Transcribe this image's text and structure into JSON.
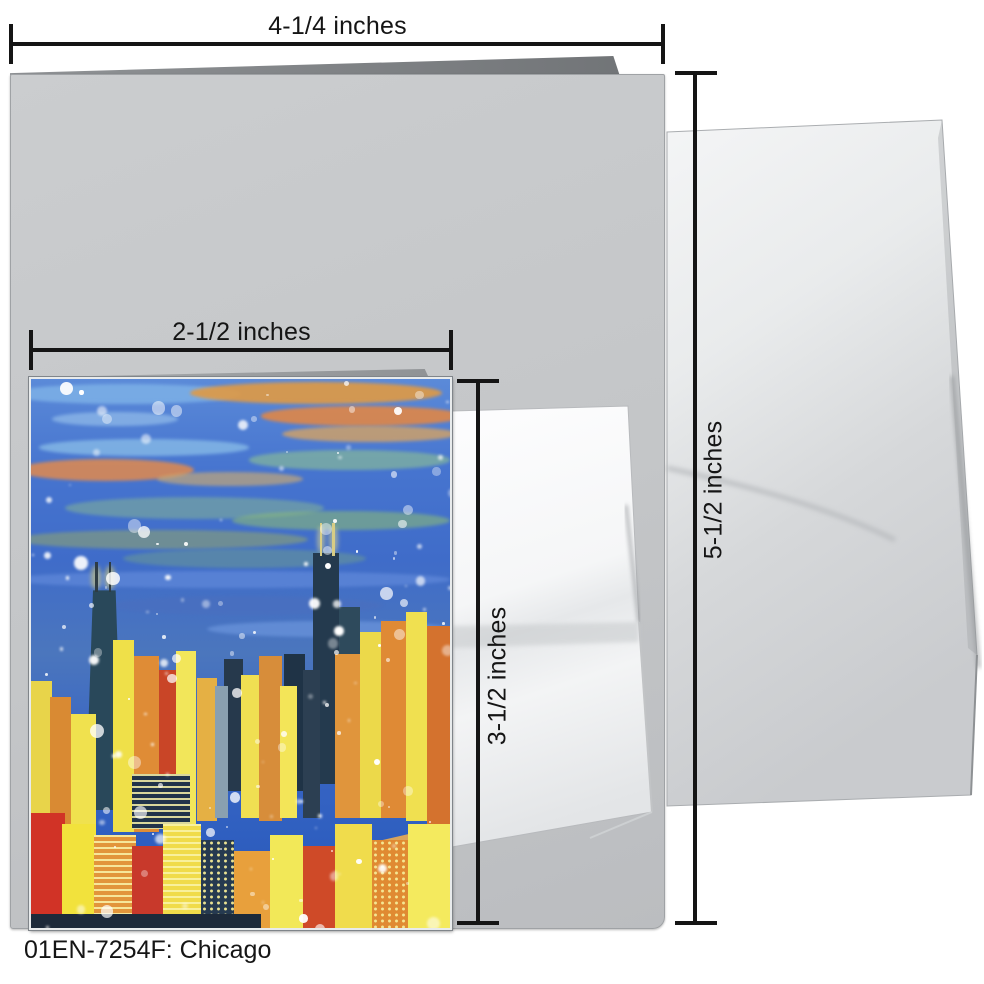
{
  "product": {
    "code_label": "01EN-7254F: Chicago"
  },
  "annotations": {
    "card_width": "4-1/4 inches",
    "card_height": "5-1/2 inches",
    "front_width": "2-1/2 inches",
    "front_height": "3-1/2 inches"
  },
  "colors": {
    "background": "#ffffff",
    "card_gray": "#c6c8ca",
    "fold_gray": "#7c7f83",
    "envelope_light": "#f4f5f6",
    "envelope_shade": "#c9cbce",
    "dimension_line": "#151515",
    "caption_text": "#151515"
  },
  "painting": {
    "sky": {
      "stops": [
        "#5b8ad8",
        "#4674cf",
        "#3f6cc9",
        "#4b76bd",
        "#3a66c4",
        "#2f5fc0",
        "#2a54b4"
      ]
    },
    "sky_streaks": [
      {
        "x": -5,
        "y": 1,
        "w": 55,
        "h": 3.5,
        "c": "#7fb3e8",
        "o": 0.8
      },
      {
        "x": 38,
        "y": 0.5,
        "w": 60,
        "h": 4,
        "c": "#e09a44",
        "o": 0.9
      },
      {
        "x": 55,
        "y": 5,
        "w": 48,
        "h": 3.5,
        "c": "#e8873f",
        "o": 0.85
      },
      {
        "x": 60,
        "y": 8.5,
        "w": 42,
        "h": 3,
        "c": "#e8a854",
        "o": 0.7
      },
      {
        "x": 5,
        "y": 6,
        "w": 30,
        "h": 2.5,
        "c": "#9fc8ee",
        "o": 0.6
      },
      {
        "x": 2,
        "y": 11,
        "w": 50,
        "h": 3,
        "c": "#8fc3ea",
        "o": 0.7
      },
      {
        "x": -3,
        "y": 14.5,
        "w": 42,
        "h": 4,
        "c": "#e28a4d",
        "o": 0.85
      },
      {
        "x": 52,
        "y": 13,
        "w": 48,
        "h": 3.5,
        "c": "#86b89a",
        "o": 0.7
      },
      {
        "x": 30,
        "y": 17,
        "w": 35,
        "h": 2.5,
        "c": "#d8b06a",
        "o": 0.6
      },
      {
        "x": 8,
        "y": 21.5,
        "w": 62,
        "h": 4,
        "c": "#7fae9a",
        "o": 0.6
      },
      {
        "x": 48,
        "y": 24,
        "w": 52,
        "h": 3.5,
        "c": "#8fbf72",
        "o": 0.55
      },
      {
        "x": -4,
        "y": 27.5,
        "w": 70,
        "h": 3.5,
        "c": "#94a86b",
        "o": 0.55
      },
      {
        "x": 22,
        "y": 31,
        "w": 58,
        "h": 3.5,
        "c": "#6f9e8e",
        "o": 0.5
      },
      {
        "x": -5,
        "y": 35,
        "w": 105,
        "h": 3,
        "c": "#5d86d8",
        "o": 0.8
      },
      {
        "x": 18,
        "y": 39.5,
        "w": 66,
        "h": 3.5,
        "c": "#4a6fbf",
        "o": 0.7
      },
      {
        "x": 42,
        "y": 44,
        "w": 58,
        "h": 3,
        "c": "#6c96dd",
        "o": 0.7
      }
    ],
    "glows": [
      {
        "x": 14.4,
        "y": 34,
        "w": 2.4,
        "h": 4.2,
        "c": "#e8d45f",
        "o": 0.5
      },
      {
        "x": 17.7,
        "y": 34,
        "w": 2.4,
        "h": 4.2,
        "c": "#e8d45f",
        "o": 0.5
      },
      {
        "x": 68.2,
        "y": 27,
        "w": 2,
        "h": 4.5,
        "c": "#f0e387",
        "o": 0.5
      },
      {
        "x": 71.2,
        "y": 27,
        "w": 2,
        "h": 4.5,
        "c": "#f0e387",
        "o": 0.5
      }
    ],
    "antennas": [
      {
        "x": 15.3,
        "y": 33.4,
        "w": 0.7,
        "h": 5.4,
        "c": "#2e3c44"
      },
      {
        "x": 18.5,
        "y": 33.4,
        "w": 0.7,
        "h": 5.4,
        "c": "#2e3c44"
      },
      {
        "x": 68.9,
        "y": 26.2,
        "w": 0.6,
        "h": 6,
        "c": "#d8cd85"
      },
      {
        "x": 71.9,
        "y": 26.2,
        "w": 0.6,
        "h": 6,
        "c": "#d8cd85"
      }
    ],
    "buildings": [
      {
        "x": 13,
        "y": 38.5,
        "w": 9,
        "h": 40,
        "c": "#29485a",
        "taper": true
      },
      {
        "x": 67.3,
        "y": 31.7,
        "w": 6.3,
        "h": 42,
        "c": "#243a4e"
      },
      {
        "x": 73.4,
        "y": 41.5,
        "w": 5.2,
        "h": 32,
        "c": "#2e4a5c"
      },
      {
        "x": 60.5,
        "y": 50,
        "w": 5,
        "h": 25,
        "c": "#1f3346"
      },
      {
        "x": 46,
        "y": 51,
        "w": 4.5,
        "h": 24,
        "c": "#26394c"
      },
      {
        "x": 0,
        "y": 55,
        "w": 5,
        "h": 30,
        "c": "#e8d44a"
      },
      {
        "x": 4.5,
        "y": 58,
        "w": 5,
        "h": 28,
        "c": "#d98a33"
      },
      {
        "x": 9.5,
        "y": 61,
        "w": 6,
        "h": 25,
        "c": "#f0e14e"
      },
      {
        "x": 19.5,
        "y": 47.5,
        "w": 5,
        "h": 35,
        "c": "#efe049"
      },
      {
        "x": 24.5,
        "y": 50.5,
        "w": 6,
        "h": 32,
        "c": "#df8c36"
      },
      {
        "x": 30.5,
        "y": 53,
        "w": 4,
        "h": 28,
        "c": "#c94527"
      },
      {
        "x": 34.5,
        "y": 49.5,
        "w": 5,
        "h": 32,
        "c": "#f2e65a"
      },
      {
        "x": 39.5,
        "y": 54.5,
        "w": 5,
        "h": 26,
        "c": "#e5b044"
      },
      {
        "x": 44,
        "y": 56,
        "w": 3,
        "h": 24,
        "c": "#8aa0b0"
      },
      {
        "x": 50,
        "y": 54,
        "w": 5,
        "h": 26,
        "c": "#f0df52"
      },
      {
        "x": 54.5,
        "y": 50.5,
        "w": 5.5,
        "h": 30,
        "c": "#d78d3a"
      },
      {
        "x": 59.5,
        "y": 56,
        "w": 4,
        "h": 24,
        "c": "#f3e558"
      },
      {
        "x": 65,
        "y": 53,
        "w": 4,
        "h": 27,
        "c": "#2c3f52"
      },
      {
        "x": 72.5,
        "y": 50,
        "w": 6,
        "h": 30,
        "c": "#e0953c"
      },
      {
        "x": 78.5,
        "y": 46,
        "w": 5,
        "h": 34,
        "c": "#ecd94a"
      },
      {
        "x": 83.5,
        "y": 44,
        "w": 6,
        "h": 36,
        "c": "#df8a35"
      },
      {
        "x": 89.5,
        "y": 42.5,
        "w": 5,
        "h": 38,
        "c": "#f0e050"
      },
      {
        "x": 94.5,
        "y": 45,
        "w": 5.5,
        "h": 36,
        "c": "#d4722e"
      },
      {
        "x": 24,
        "y": 72,
        "w": 14,
        "h": 10,
        "c": "#22344a",
        "win": "lines"
      },
      {
        "x": 38,
        "y": 86,
        "w": 70,
        "h": 5,
        "c": "#d9a45c",
        "rot": -13
      },
      {
        "x": 0,
        "y": 93,
        "w": 40,
        "h": 3.5,
        "c": "#c89050",
        "rot": -5
      },
      {
        "x": 0,
        "y": 79,
        "w": 8,
        "h": 21,
        "c": "#d13326"
      },
      {
        "x": 7.5,
        "y": 81,
        "w": 8,
        "h": 19,
        "c": "#f2e23c"
      },
      {
        "x": 15,
        "y": 83,
        "w": 10,
        "h": 17,
        "c": "#e2953b",
        "win": "lines"
      },
      {
        "x": 24,
        "y": 85,
        "w": 8,
        "h": 15,
        "c": "#c8392b"
      },
      {
        "x": 31.5,
        "y": 81,
        "w": 9,
        "h": 19,
        "c": "#f0db4a",
        "win": "lines"
      },
      {
        "x": 40.5,
        "y": 84,
        "w": 8,
        "h": 16,
        "c": "#263a50",
        "win": "dots"
      },
      {
        "x": 48.5,
        "y": 86,
        "w": 9,
        "h": 14,
        "c": "#e8a03c"
      },
      {
        "x": 57,
        "y": 83,
        "w": 8,
        "h": 17,
        "c": "#f2e858"
      },
      {
        "x": 65,
        "y": 85,
        "w": 8,
        "h": 15,
        "c": "#cf4a28"
      },
      {
        "x": 72.5,
        "y": 81,
        "w": 9,
        "h": 19,
        "c": "#f0dc4c"
      },
      {
        "x": 81.5,
        "y": 84,
        "w": 9,
        "h": 16,
        "c": "#e08a32",
        "win": "dots"
      },
      {
        "x": 90,
        "y": 81,
        "w": 10,
        "h": 19,
        "c": "#f4ea5e"
      },
      {
        "x": 0,
        "y": 97.5,
        "w": 55,
        "h": 2.5,
        "c": "#1d2a3a"
      }
    ],
    "snow": {
      "seed": 9,
      "count": 150,
      "color": "#ffffff"
    }
  }
}
